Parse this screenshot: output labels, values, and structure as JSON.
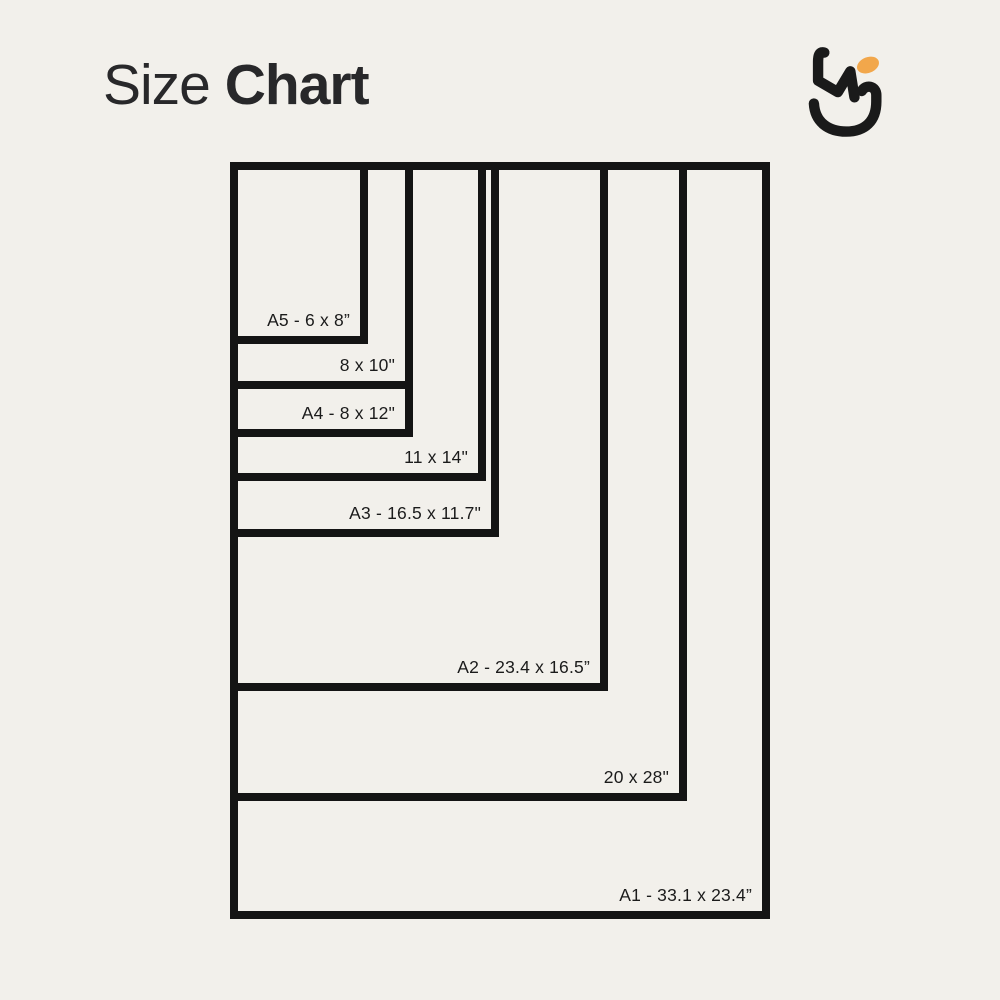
{
  "page": {
    "title_regular": "Size",
    "title_bold": "Chart",
    "background_color": "#f2f0eb",
    "title_color": "#28282a"
  },
  "logo": {
    "ink_color": "#1a1a1a",
    "accent_color": "#f2a74b"
  },
  "chart_data": {
    "type": "nested-rectangles-size-chart",
    "title": "Size Chart",
    "units": "inches",
    "anchor": "shared top-left corner",
    "border_color": "#141414",
    "border_px": 8,
    "origin_px": {
      "x": 230,
      "y": 162
    },
    "sizes": [
      {
        "name": "A5",
        "label": "A5 - 6 x 8”",
        "width_in": 6,
        "height_in": 8,
        "box_px": {
          "w": 138,
          "h": 182
        }
      },
      {
        "name": "8x10",
        "label": "8 x 10\"",
        "width_in": 8,
        "height_in": 10,
        "box_px": {
          "w": 183,
          "h": 227
        }
      },
      {
        "name": "A4",
        "label": "A4 - 8 x 12\"",
        "width_in": 8,
        "height_in": 12,
        "box_px": {
          "w": 183,
          "h": 275
        }
      },
      {
        "name": "11x14",
        "label": "11 x 14\"",
        "width_in": 11,
        "height_in": 14,
        "box_px": {
          "w": 256,
          "h": 319
        }
      },
      {
        "name": "A3",
        "label": "A3 - 16.5 x 11.7\"",
        "width_in": 11.7,
        "height_in": 16.5,
        "box_px": {
          "w": 269,
          "h": 375
        }
      },
      {
        "name": "A2",
        "label": "A2 - 23.4 x 16.5”",
        "width_in": 16.5,
        "height_in": 23.4,
        "box_px": {
          "w": 378,
          "h": 529
        }
      },
      {
        "name": "20x28",
        "label": "20 x 28\"",
        "width_in": 20,
        "height_in": 28,
        "box_px": {
          "w": 457,
          "h": 639
        }
      },
      {
        "name": "A1",
        "label": "A1 - 33.1 x 23.4”",
        "width_in": 23.4,
        "height_in": 33.1,
        "box_px": {
          "w": 540,
          "h": 757
        }
      }
    ]
  }
}
